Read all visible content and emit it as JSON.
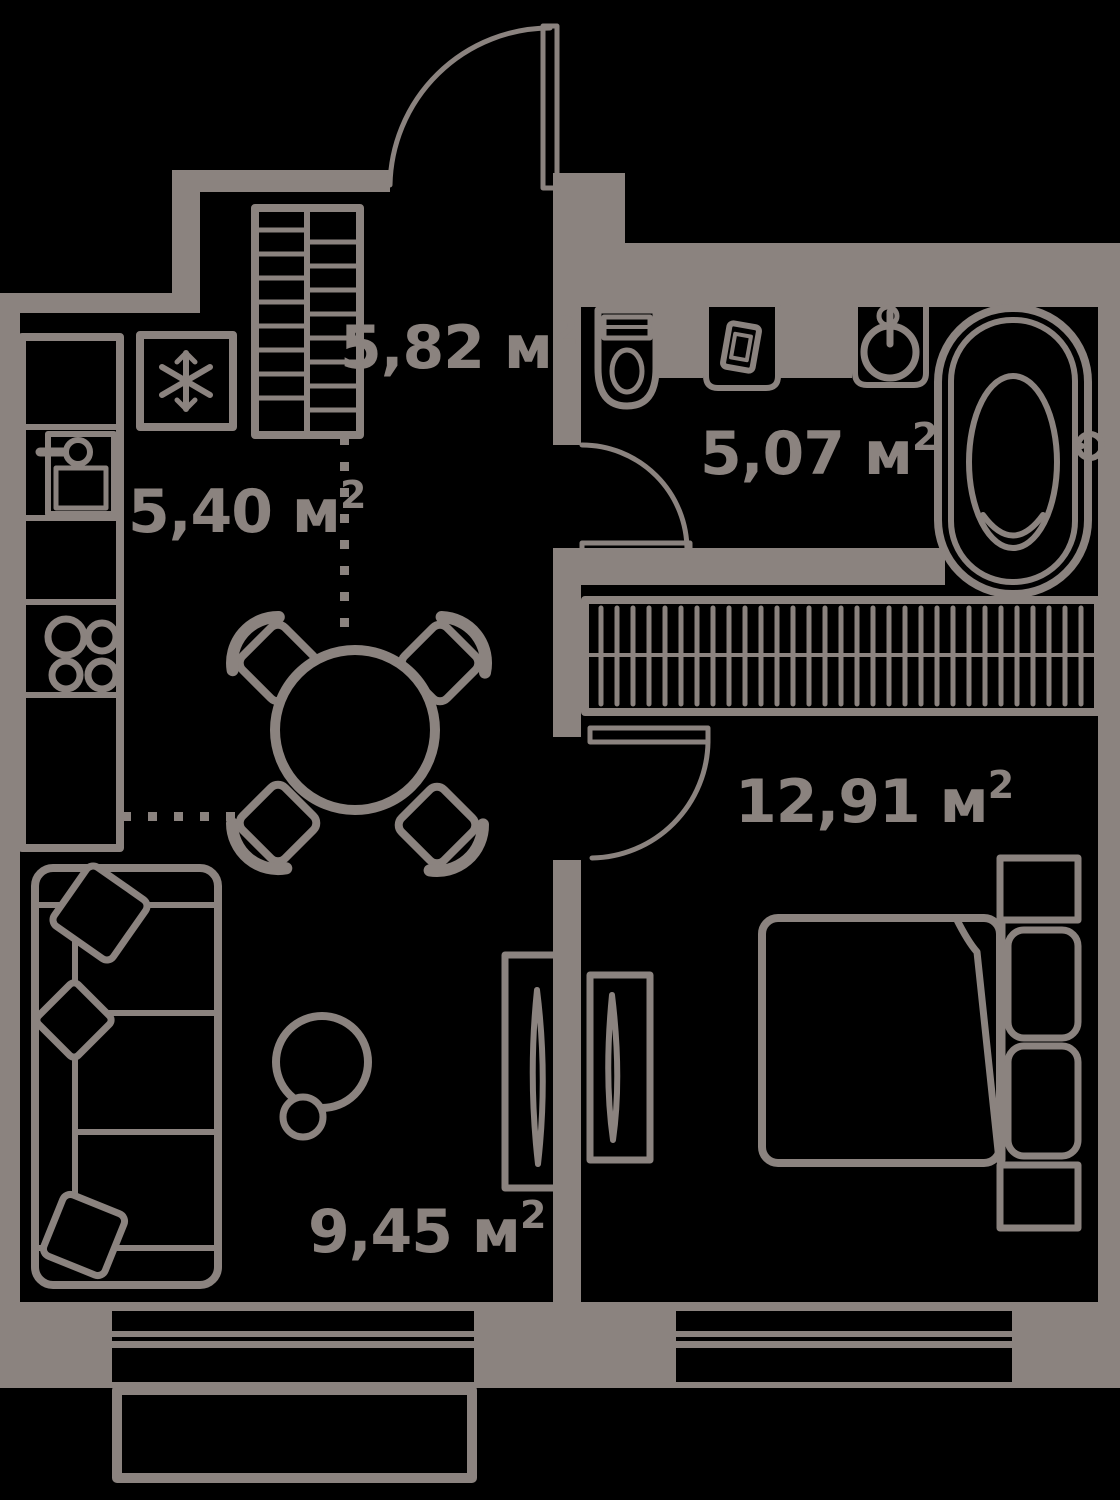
{
  "plan": {
    "type": "apartment-floor-plan",
    "colors": {
      "line": "#8b837f",
      "background": "#000000"
    },
    "rooms": [
      {
        "id": "hallway",
        "area_value": "5,82",
        "unit": "м",
        "area_label": "5,82 м",
        "area_sup": "2"
      },
      {
        "id": "kitchen",
        "area_value": "5,40",
        "unit": "м",
        "area_label": "5,40 м",
        "area_sup": "2"
      },
      {
        "id": "bathroom",
        "area_value": "5,07",
        "unit": "м",
        "area_label": "5,07 м",
        "area_sup": "2"
      },
      {
        "id": "bedroom",
        "area_value": "12,91",
        "unit": "м",
        "area_label": "12,91 м",
        "area_sup": "2"
      },
      {
        "id": "living-room",
        "area_value": "9,45",
        "unit": "м",
        "area_label": "9,45 м",
        "area_sup": "2"
      }
    ]
  }
}
